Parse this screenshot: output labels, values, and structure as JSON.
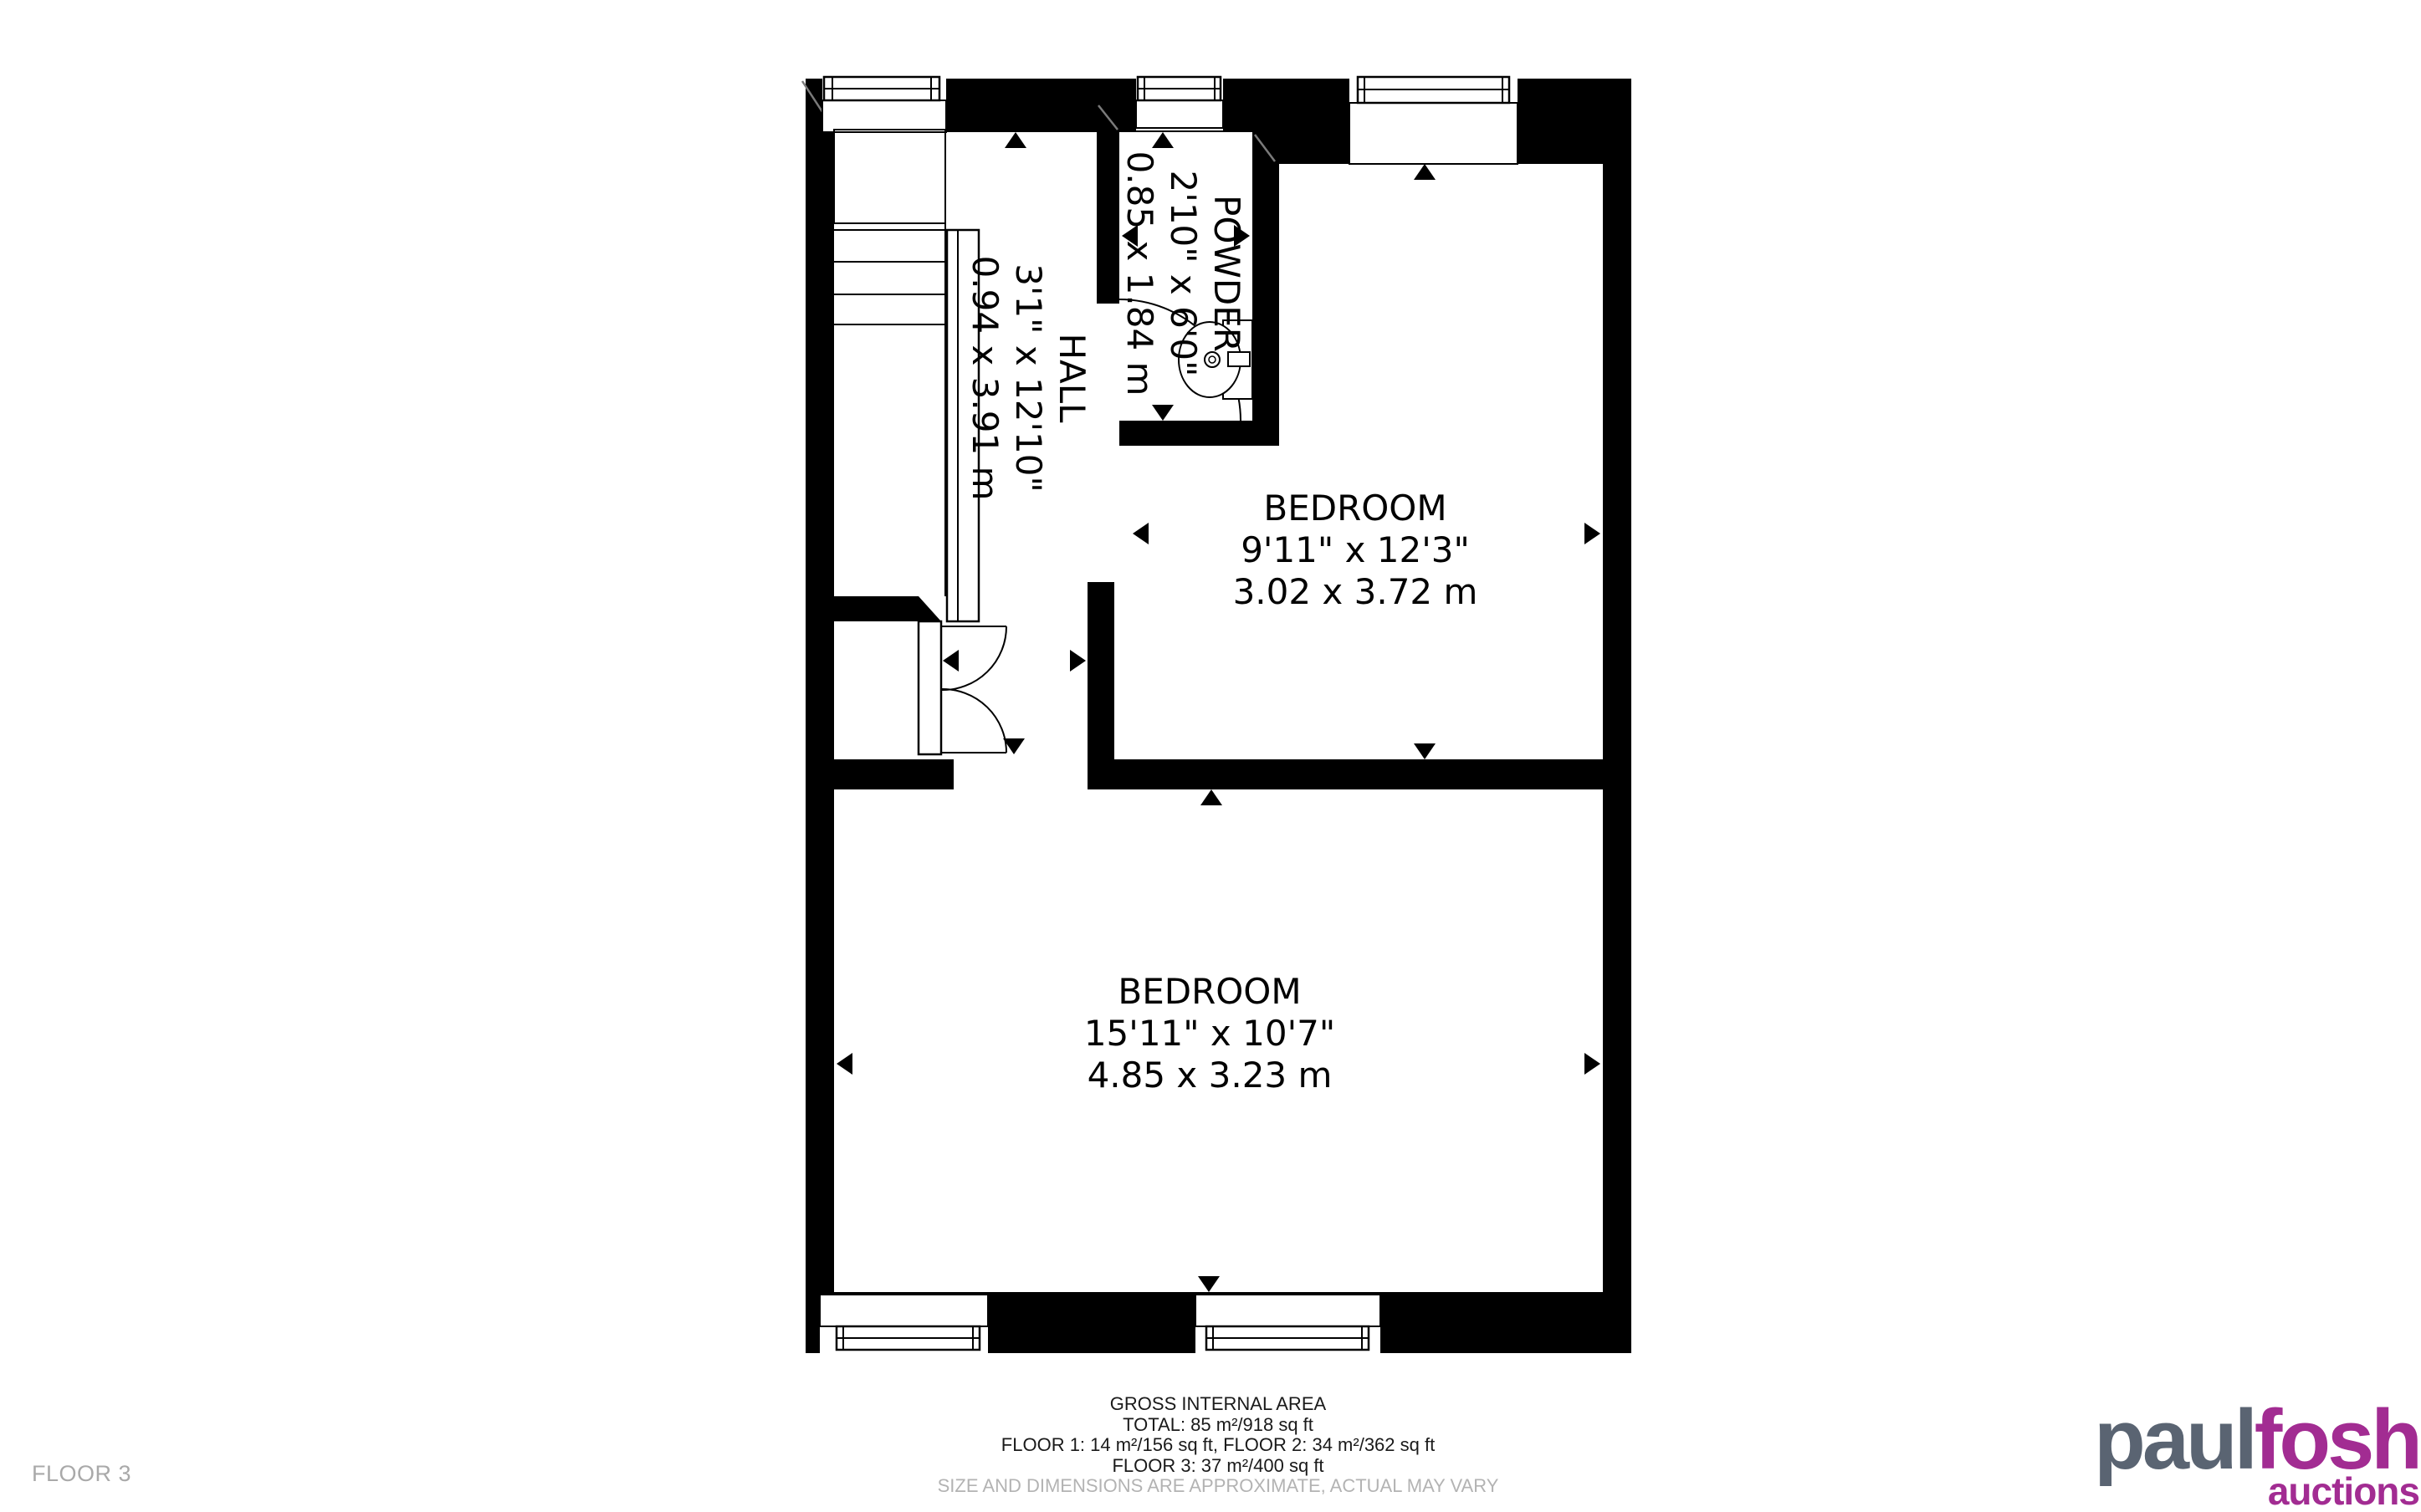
{
  "plan": {
    "rooms": {
      "powder": {
        "name": "POWDER",
        "imperial": "2'10\" x 6'0\"",
        "metric": "0.85 x 1.84 m"
      },
      "hall": {
        "name": "HALL",
        "imperial": "3'1\" x 12'10\"",
        "metric": "0.94 x 3.91 m"
      },
      "bedroom1": {
        "name": "BEDROOM",
        "imperial": "9'11\" x 12'3\"",
        "metric": "3.02 x 3.72 m"
      },
      "bedroom2": {
        "name": "BEDROOM",
        "imperial": "15'11\" x 10'7\"",
        "metric": "4.85 x 3.23 m"
      }
    }
  },
  "footer": {
    "heading": "GROSS INTERNAL AREA",
    "total": "TOTAL: 85 m²/918 sq ft",
    "floors_1_2": "FLOOR 1: 14 m²/156 sq ft, FLOOR 2: 34 m²/362 sq ft",
    "floor_3": "FLOOR 3: 37 m²/400 sq ft",
    "disclaimer": "SIZE AND DIMENSIONS ARE APPROXIMATE, ACTUAL MAY VARY"
  },
  "floor_label": "FLOOR 3",
  "logo": {
    "part1": "paul",
    "part2": "fosh",
    "tagline": "auctions",
    "part1_color": "#5a6472",
    "accent_color": "#a22c92"
  },
  "colors": {
    "wall": "#000000",
    "label_text": "#000000",
    "muted_label": "#a9a9a9",
    "disclaimer": "#b3b3b3"
  }
}
